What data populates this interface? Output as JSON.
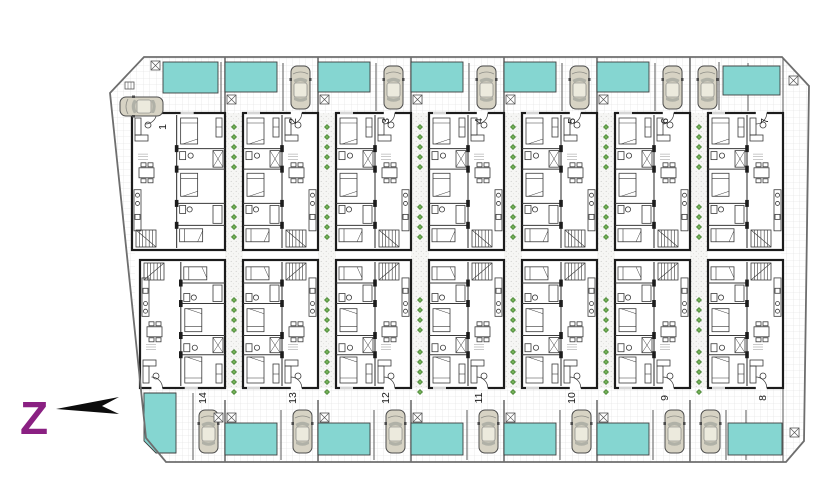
{
  "drawing": {
    "type": "residential-site-plan",
    "unit_count": 14,
    "rows": {
      "top": [
        "1",
        "2",
        "3",
        "4",
        "5",
        "6",
        "7"
      ],
      "bottom": [
        "14",
        "13",
        "12",
        "11",
        "10",
        "9",
        "8"
      ]
    }
  },
  "compass": {
    "letter": "Z",
    "arrow_direction": "left"
  },
  "colors": {
    "pool": "#85D6D1",
    "pool_border": "#3F3F3F",
    "wall": "#1C1C1C",
    "thin": "#3A3A3A",
    "grid_line": "#DEDEDE",
    "stipple": "#C9C9C6",
    "car_body": "#D7D3C4",
    "car_roof": "#ECEADD",
    "car_glass": "#A9AAA2",
    "shrub_dark": "#4E8A3B",
    "shrub_light": "#7AB55C",
    "compass_letter": "#8A2082",
    "boundary": "#6E6E6E",
    "band_wall": "#5A5A5A",
    "label_text": "#1A1A1A"
  },
  "units": [
    {
      "number": "1",
      "row": "top",
      "cell": 0,
      "end_unit": true,
      "living_side": "left"
    },
    {
      "number": "2",
      "row": "top",
      "cell": 1,
      "end_unit": false,
      "living_side": "right"
    },
    {
      "number": "3",
      "row": "top",
      "cell": 2,
      "end_unit": false,
      "living_side": "right"
    },
    {
      "number": "4",
      "row": "top",
      "cell": 3,
      "end_unit": false,
      "living_side": "right"
    },
    {
      "number": "5",
      "row": "top",
      "cell": 4,
      "end_unit": false,
      "living_side": "right"
    },
    {
      "number": "6",
      "row": "top",
      "cell": 5,
      "end_unit": false,
      "living_side": "right"
    },
    {
      "number": "7",
      "row": "top",
      "cell": 6,
      "end_unit": true,
      "living_side": "right"
    },
    {
      "number": "8",
      "row": "bottom",
      "cell": 6,
      "end_unit": true,
      "living_side": "right"
    },
    {
      "number": "9",
      "row": "bottom",
      "cell": 5,
      "end_unit": false,
      "living_side": "right"
    },
    {
      "number": "10",
      "row": "bottom",
      "cell": 4,
      "end_unit": false,
      "living_side": "right"
    },
    {
      "number": "11",
      "row": "bottom",
      "cell": 3,
      "end_unit": false,
      "living_side": "right"
    },
    {
      "number": "12",
      "row": "bottom",
      "cell": 2,
      "end_unit": false,
      "living_side": "right"
    },
    {
      "number": "13",
      "row": "bottom",
      "cell": 1,
      "end_unit": false,
      "living_side": "right"
    },
    {
      "number": "14",
      "row": "bottom",
      "cell": 0,
      "end_unit": true,
      "living_side": "left"
    }
  ],
  "features": {
    "pools_top": 7,
    "pools_bottom": 7,
    "cars_top": 7,
    "cars_bottom": 7,
    "shrub_walkways": 6
  }
}
